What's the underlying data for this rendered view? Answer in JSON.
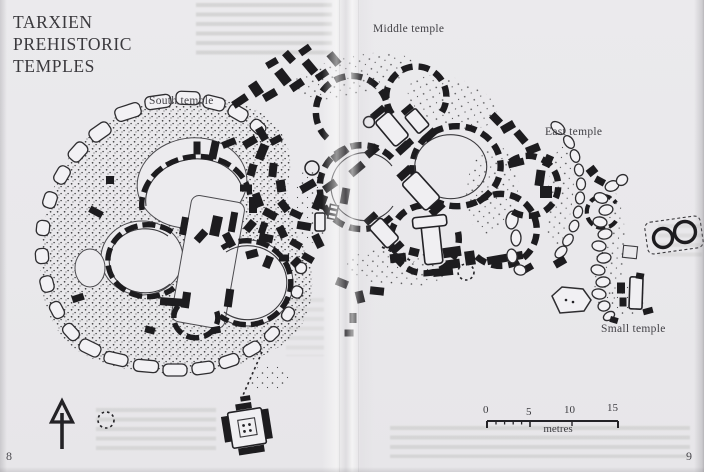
{
  "title": {
    "line1": "TARXIEN",
    "line2": "PREHISTORIC",
    "line3": "TEMPLES"
  },
  "plan_labels": {
    "south": "South temple",
    "middle": "Middle temple",
    "east": "East temple",
    "small": "Small temple"
  },
  "scale_bar": {
    "tick_0": "0",
    "tick_5": "5",
    "tick_10": "10",
    "tick_15": "15",
    "unit": "metres"
  },
  "page_numbers": {
    "left": "8",
    "right": "9"
  },
  "icons": {
    "north_arrow": "north-arrow"
  },
  "colors": {
    "paper": "#eae9ec",
    "ink": "#1d1c1f"
  }
}
